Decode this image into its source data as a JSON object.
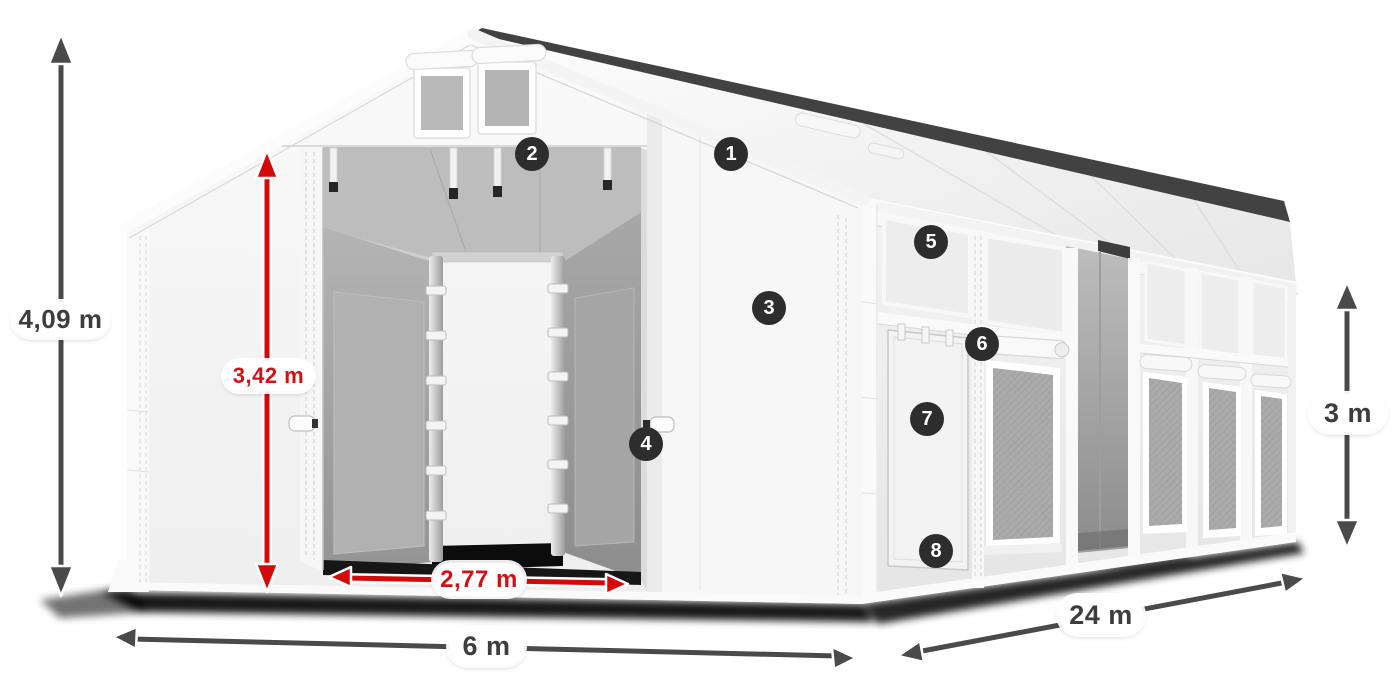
{
  "figure": {
    "type": "product-dimension-diagram",
    "subject": "industrial storage tent with open front gates, side door and mesh windows"
  },
  "colors": {
    "accent_red": "#d21114",
    "dimension_dark": "#3d3d3d",
    "badge_bg": "#2d2d2d",
    "badge_text": "#ffffff",
    "background": "#ffffff"
  },
  "dimensions": {
    "total_height": {
      "label": "4,09 m",
      "color": "dark"
    },
    "entrance_height": {
      "label": "3,42 m",
      "color": "red"
    },
    "entrance_width": {
      "label": "2,77 m",
      "color": "red"
    },
    "tent_width": {
      "label": "6 m",
      "color": "dark"
    },
    "tent_length": {
      "label": "24 m",
      "color": "dark"
    },
    "side_height": {
      "label": "3 m",
      "color": "dark"
    }
  },
  "callouts": [
    {
      "number": "1"
    },
    {
      "number": "2"
    },
    {
      "number": "3"
    },
    {
      "number": "4"
    },
    {
      "number": "5"
    },
    {
      "number": "6"
    },
    {
      "number": "7"
    },
    {
      "number": "8"
    }
  ]
}
